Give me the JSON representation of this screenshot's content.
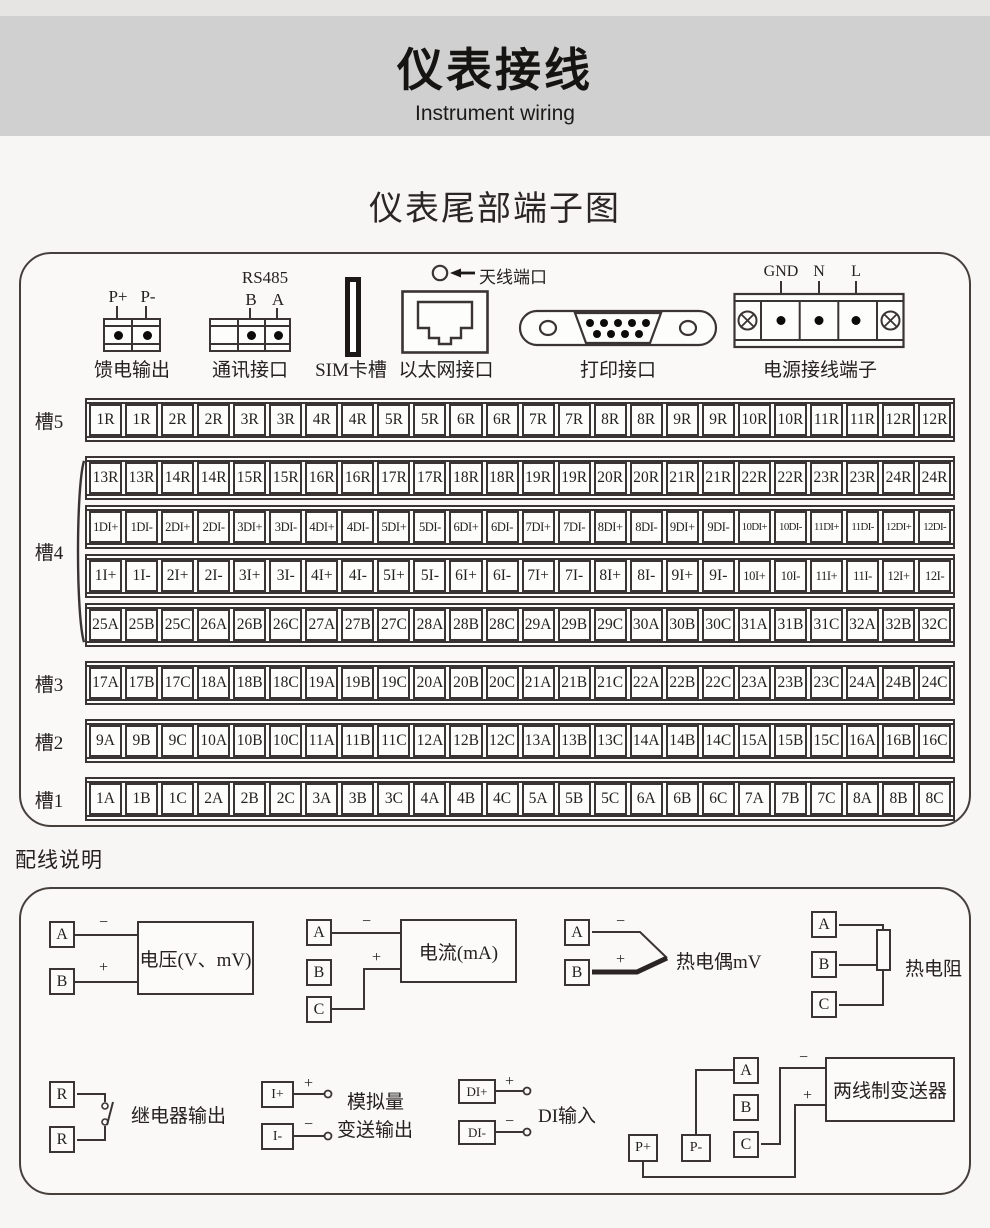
{
  "page": {
    "title": "仪表接线",
    "subtitle": "Instrument wiring",
    "section_terminals_title": "仪表尾部端子图",
    "section_wiring_title": "配线说明"
  },
  "colors": {
    "line": "#3a3432",
    "header_band": "#d1d0d0",
    "page_bg": "#f7f6f5"
  },
  "connectors": {
    "feed": {
      "label": "馈电输出",
      "pins": [
        "P+",
        "P-"
      ]
    },
    "comm": {
      "label": "通讯接口",
      "protocol": "RS485",
      "pins": [
        "B",
        "A"
      ]
    },
    "sim": {
      "label": "SIM卡槽"
    },
    "ethernet": {
      "label": "以太网接口"
    },
    "antenna": {
      "label": "天线端口"
    },
    "printer": {
      "label": "打印接口"
    },
    "power": {
      "label": "电源接线端子",
      "pins": [
        "GND",
        "N",
        "L"
      ]
    }
  },
  "slots": [
    {
      "label": "槽5",
      "rows": [
        [
          "1R",
          "1R",
          "2R",
          "2R",
          "3R",
          "3R",
          "4R",
          "4R",
          "5R",
          "5R",
          "6R",
          "6R",
          "7R",
          "7R",
          "8R",
          "8R",
          "9R",
          "9R",
          "10R",
          "10R",
          "11R",
          "11R",
          "12R",
          "12R"
        ]
      ]
    },
    {
      "label": "槽4",
      "rows": [
        [
          "13R",
          "13R",
          "14R",
          "14R",
          "15R",
          "15R",
          "16R",
          "16R",
          "17R",
          "17R",
          "18R",
          "18R",
          "19R",
          "19R",
          "20R",
          "20R",
          "21R",
          "21R",
          "22R",
          "22R",
          "23R",
          "23R",
          "24R",
          "24R"
        ],
        [
          "1DI+",
          "1DI-",
          "2DI+",
          "2DI-",
          "3DI+",
          "3DI-",
          "4DI+",
          "4DI-",
          "5DI+",
          "5DI-",
          "6DI+",
          "6DI-",
          "7DI+",
          "7DI-",
          "8DI+",
          "8DI-",
          "9DI+",
          "9DI-",
          "10DI+",
          "10DI-",
          "11DI+",
          "11DI-",
          "12DI+",
          "12DI-"
        ],
        [
          "1I+",
          "1I-",
          "2I+",
          "2I-",
          "3I+",
          "3I-",
          "4I+",
          "4I-",
          "5I+",
          "5I-",
          "6I+",
          "6I-",
          "7I+",
          "7I-",
          "8I+",
          "8I-",
          "9I+",
          "9I-",
          "10I+",
          "10I-",
          "11I+",
          "11I-",
          "12I+",
          "12I-"
        ],
        [
          "25A",
          "25B",
          "25C",
          "26A",
          "26B",
          "26C",
          "27A",
          "27B",
          "27C",
          "28A",
          "28B",
          "28C",
          "29A",
          "29B",
          "29C",
          "30A",
          "30B",
          "30C",
          "31A",
          "31B",
          "31C",
          "32A",
          "32B",
          "32C"
        ]
      ]
    },
    {
      "label": "槽3",
      "rows": [
        [
          "17A",
          "17B",
          "17C",
          "18A",
          "18B",
          "18C",
          "19A",
          "19B",
          "19C",
          "20A",
          "20B",
          "20C",
          "21A",
          "21B",
          "21C",
          "22A",
          "22B",
          "22C",
          "23A",
          "23B",
          "23C",
          "24A",
          "24B",
          "24C"
        ]
      ]
    },
    {
      "label": "槽2",
      "rows": [
        [
          "9A",
          "9B",
          "9C",
          "10A",
          "10B",
          "10C",
          "11A",
          "11B",
          "11C",
          "12A",
          "12B",
          "12C",
          "13A",
          "13B",
          "13C",
          "14A",
          "14B",
          "14C",
          "15A",
          "15B",
          "15C",
          "16A",
          "16B",
          "16C"
        ]
      ]
    },
    {
      "label": "槽1",
      "rows": [
        [
          "1A",
          "1B",
          "1C",
          "2A",
          "2B",
          "2C",
          "3A",
          "3B",
          "3C",
          "4A",
          "4B",
          "4C",
          "5A",
          "5B",
          "5C",
          "6A",
          "6B",
          "6C",
          "7A",
          "7B",
          "7C",
          "8A",
          "8B",
          "8C"
        ]
      ]
    }
  ],
  "wiring": {
    "voltage": {
      "terminals": [
        "A",
        "B"
      ],
      "signs": [
        "−",
        "+"
      ],
      "label": "电压(V、mV)"
    },
    "current": {
      "terminals": [
        "A",
        "B",
        "C"
      ],
      "signs": [
        "−",
        "+"
      ],
      "label": "电流(mA)"
    },
    "thermocouple": {
      "terminals": [
        "A",
        "B"
      ],
      "signs": [
        "−",
        "+"
      ],
      "label": "热电偶mV"
    },
    "rtd": {
      "terminals": [
        "A",
        "B",
        "C"
      ],
      "label": "热电阻"
    },
    "relay": {
      "terminals": [
        "R",
        "R"
      ],
      "label": "继电器输出"
    },
    "analog_out": {
      "terminals": [
        "I+",
        "I-"
      ],
      "signs": [
        "+",
        "−"
      ],
      "label_line1": "模拟量",
      "label_line2": "变送输出"
    },
    "di": {
      "terminals": [
        "DI+",
        "DI-"
      ],
      "signs": [
        "+",
        "−"
      ],
      "label": "DI输入"
    },
    "transmitter": {
      "terminals": [
        "P+",
        "P-",
        "A",
        "B",
        "C"
      ],
      "signs": [
        "−",
        "+"
      ],
      "label": "两线制变送器"
    }
  }
}
